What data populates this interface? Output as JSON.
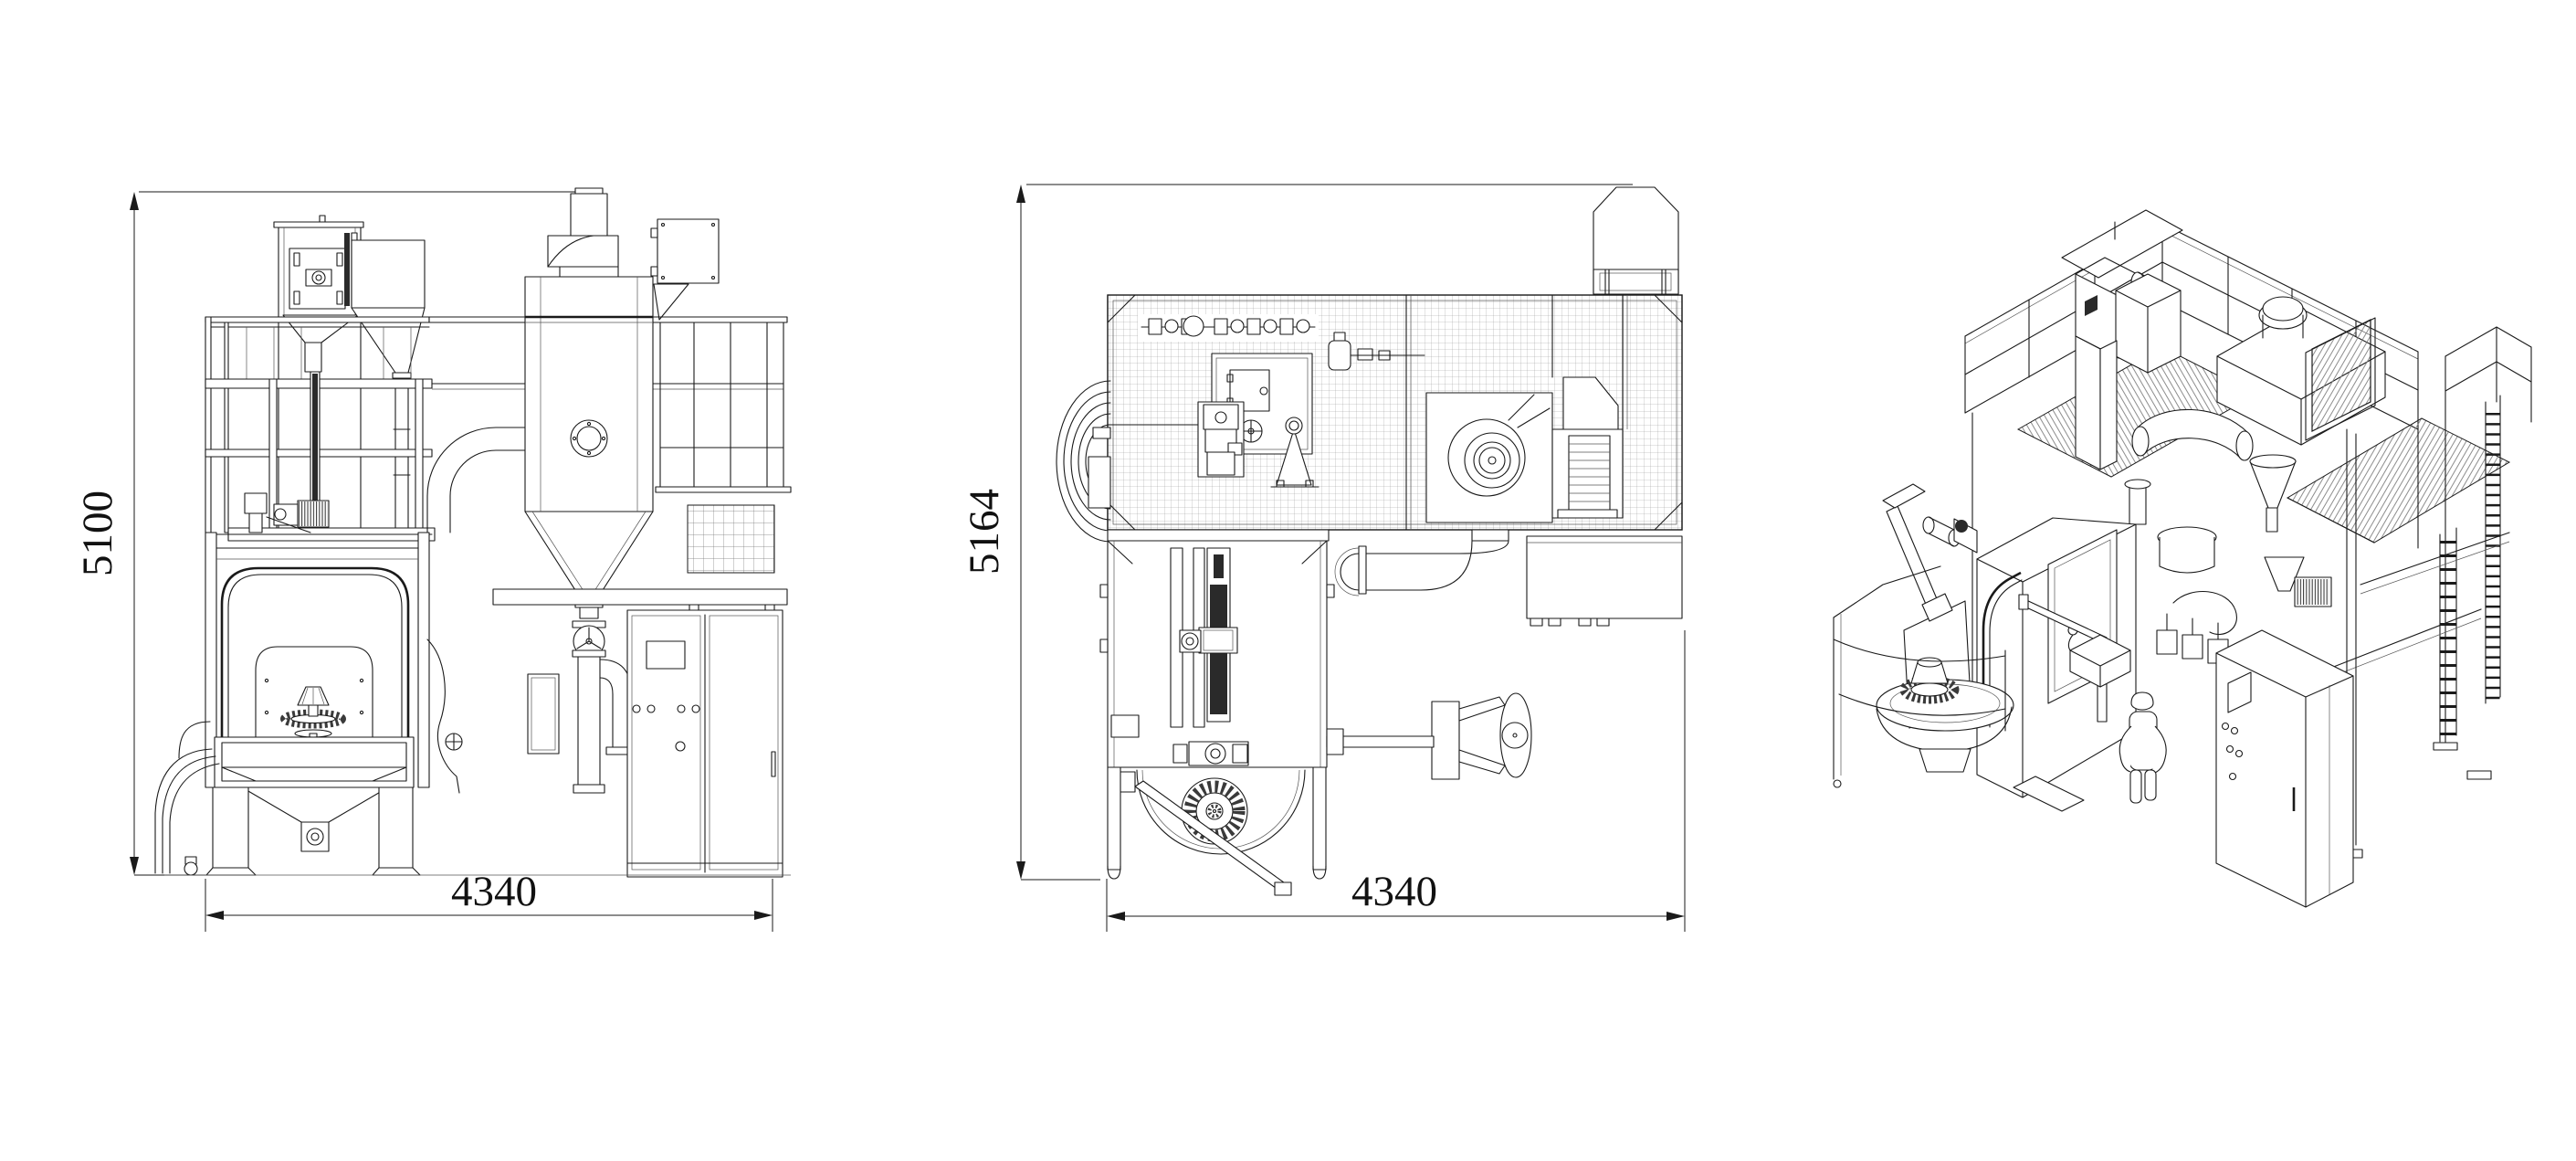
{
  "drawing": {
    "type": "cad-engineering-drawing",
    "subject": "shot-blast machine general arrangement, three views",
    "background_color": "#ffffff",
    "line_color": "#1a1a1a",
    "views": {
      "front": {
        "name": "front-elevation",
        "height_dim": "5100",
        "width_dim": "4340"
      },
      "plan": {
        "name": "side-plan-view",
        "height_dim": "5164",
        "width_dim": "4340"
      },
      "isometric": {
        "name": "isometric-view"
      }
    }
  }
}
